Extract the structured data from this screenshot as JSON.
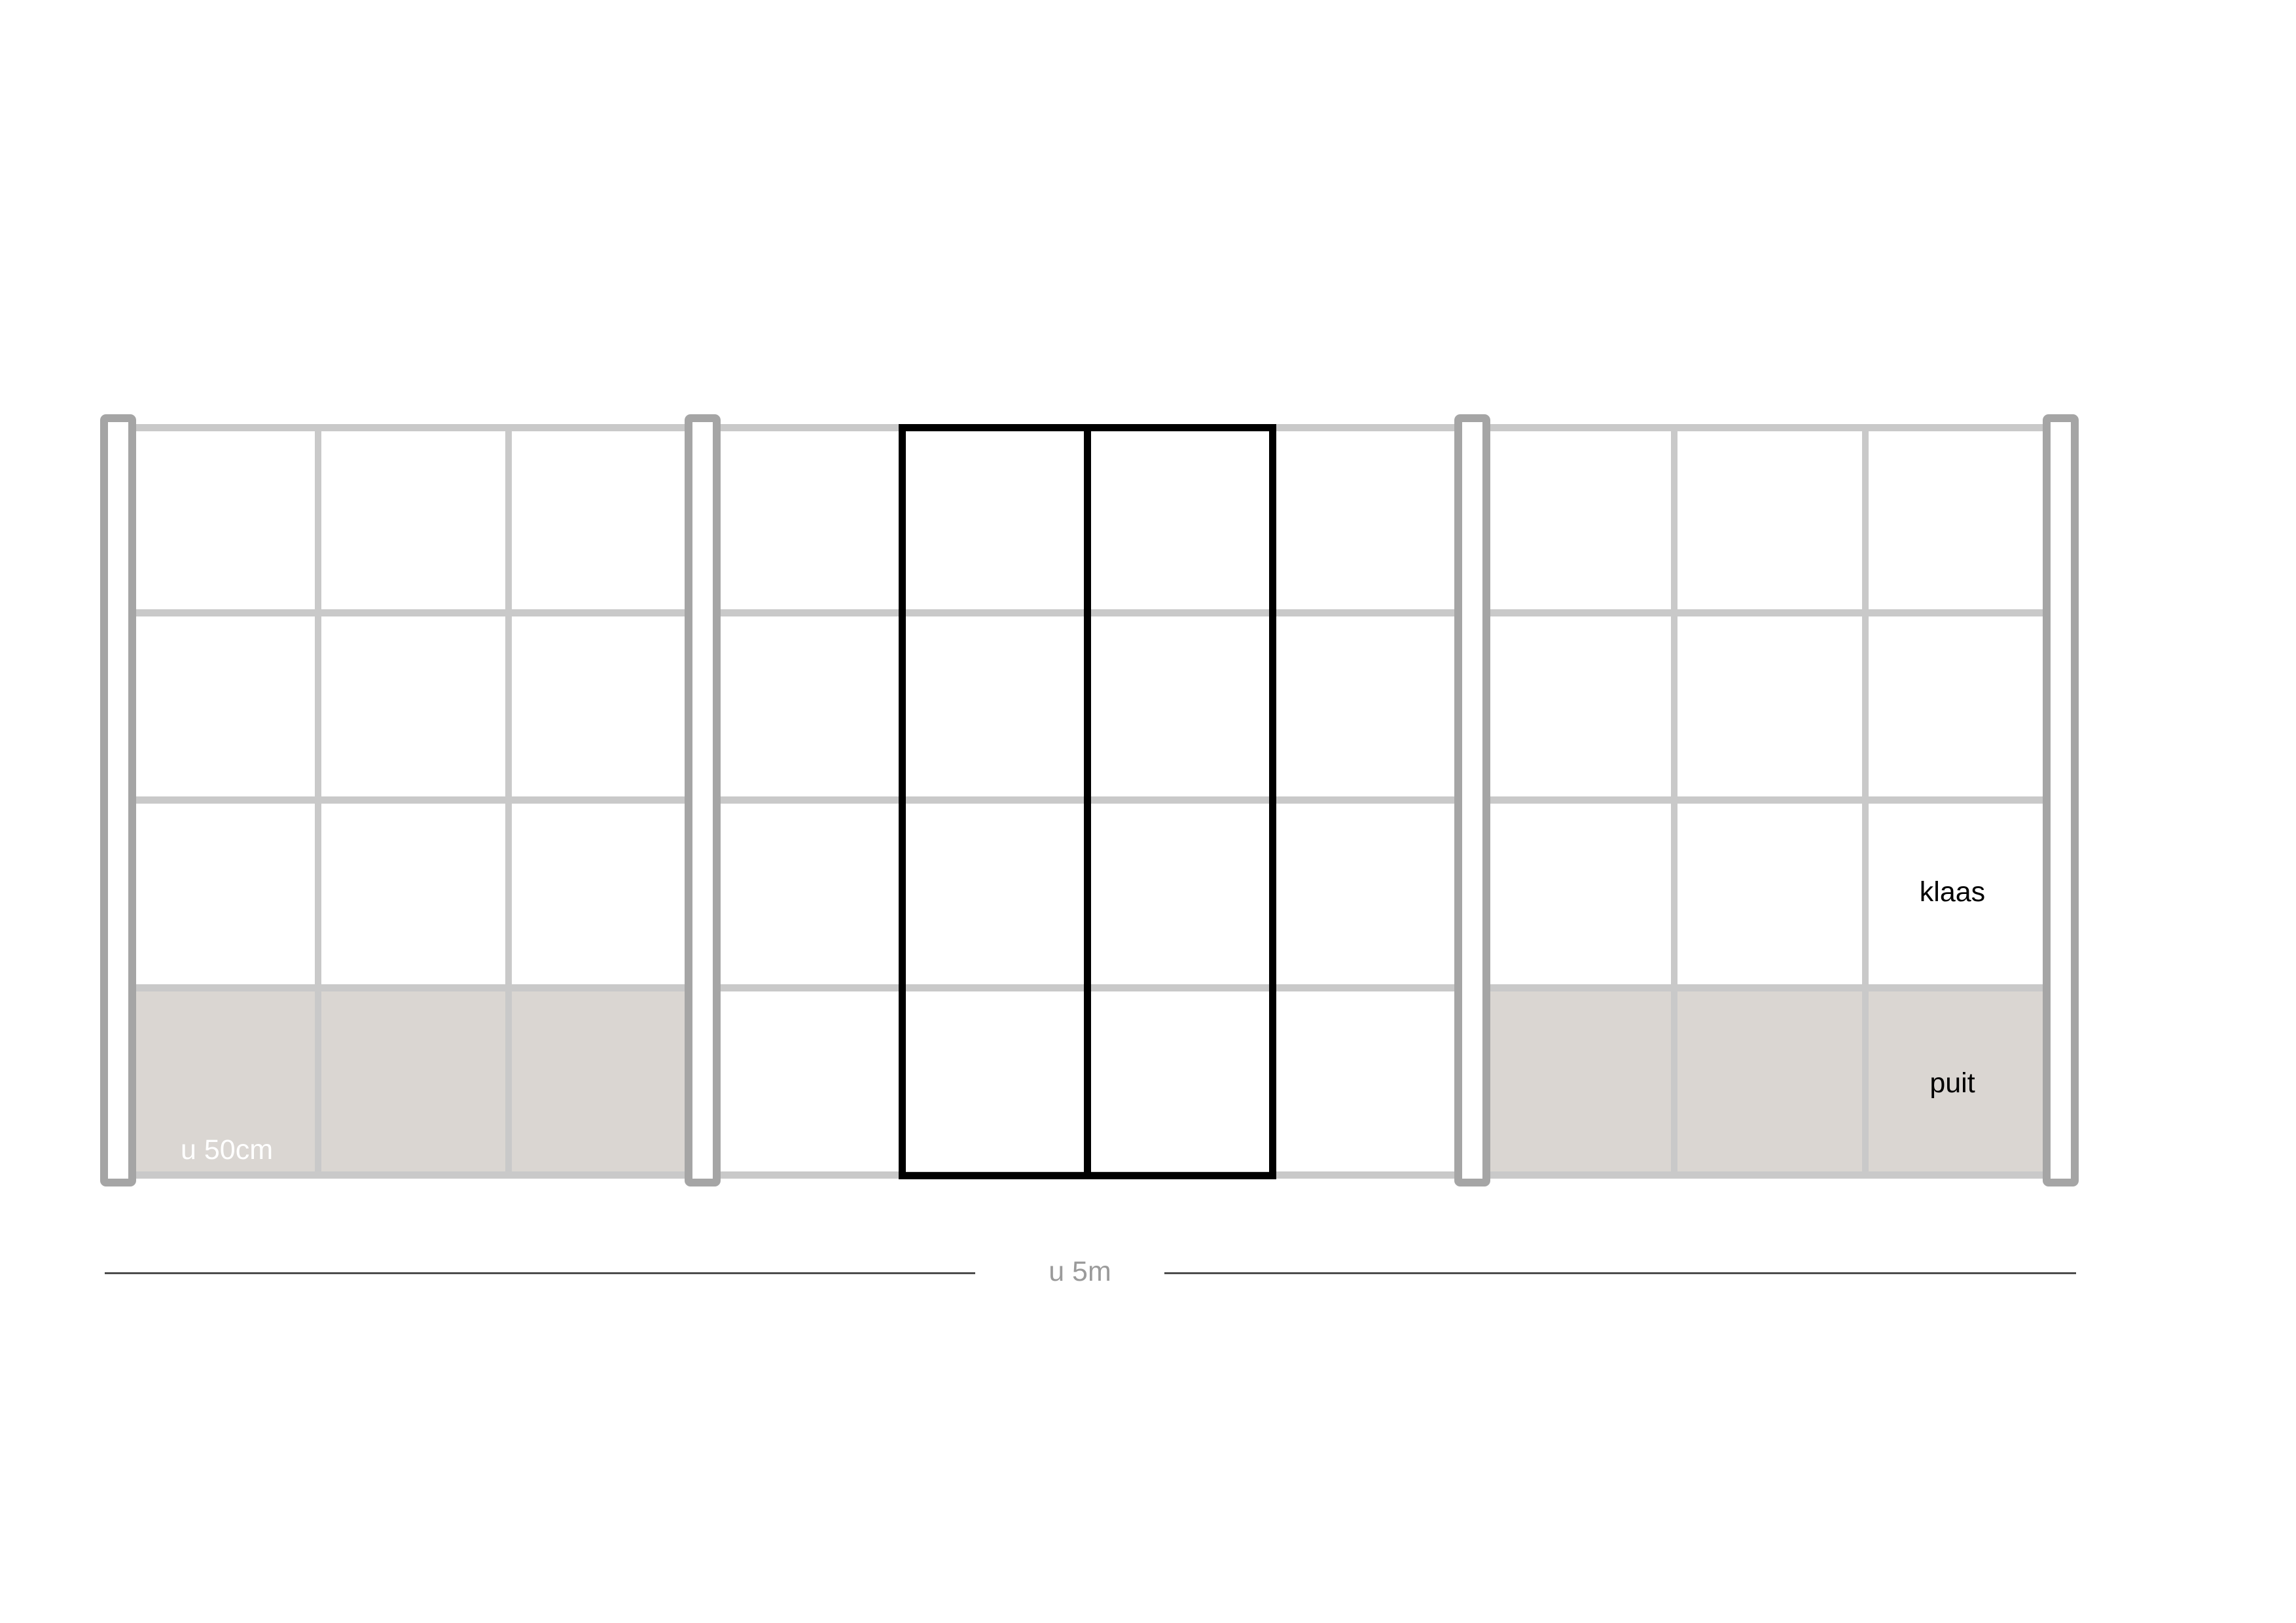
{
  "labels": {
    "panel_width": "u 50cm",
    "glass": "klaas",
    "wood": "puit",
    "total_width": "u 5m"
  },
  "colors": {
    "background": "#ffffff",
    "grid_rail": "#c9c9c9",
    "post_border": "#a5a5a5",
    "post_fill": "#ffffff",
    "wood_panel_fill": "#dad6d2",
    "door_frame": "#000000",
    "dimension_line": "#4d4d4d",
    "label_on_wood": "#ffffff",
    "label_dark": "#000000",
    "label_dimension": "#9b9b9b"
  },
  "structure": {
    "type": "fence-elevation-drawing",
    "posts": 4,
    "sections": 3,
    "rows_per_section": 4,
    "columns_left_section": 3,
    "columns_middle_section": 4,
    "columns_right_section": 3,
    "door_leaves": 2,
    "wood_panel_rows": [
      "left-section-bottom-row",
      "right-section-bottom-row"
    ]
  }
}
